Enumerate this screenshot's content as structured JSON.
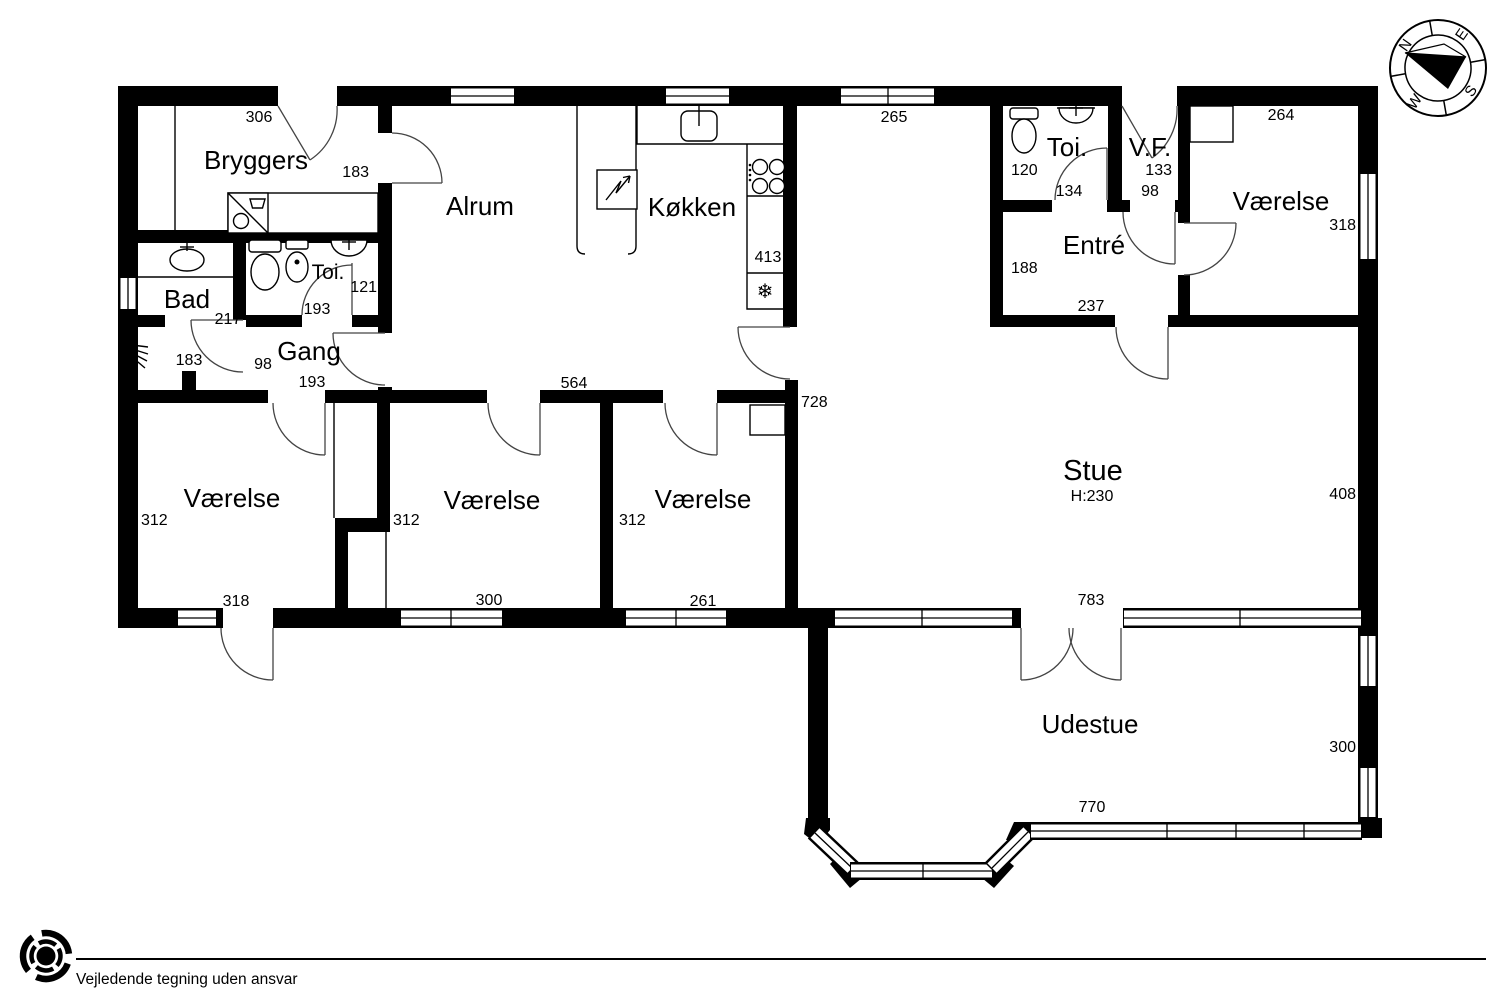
{
  "rooms": {
    "bryggers": {
      "name": "Bryggers",
      "top_width": "306",
      "door_width": "183"
    },
    "bad": {
      "name": "Bad",
      "width": "217",
      "lower_width": "183"
    },
    "toi_west": {
      "name": "Toi.",
      "width": "121",
      "door_width": "193"
    },
    "gang": {
      "name": "Gang",
      "door_width": "98",
      "south_door_width": "193"
    },
    "alrum": {
      "name": "Alrum",
      "south_width": "564"
    },
    "kokken": {
      "name": "Køkken",
      "width": "413"
    },
    "stue": {
      "name": "Stue",
      "ceiling_height": "H:230",
      "west_wall": "728",
      "east_wall": "408",
      "north_window": "265",
      "south_width": "783"
    },
    "toi_east": {
      "name": "Toi.",
      "width": "120",
      "door_width": "134"
    },
    "vf": {
      "name": "V.F.",
      "width": "133",
      "door_width": "98"
    },
    "entre": {
      "name": "Entré",
      "width": "188",
      "south_width": "237"
    },
    "vaerelse_ne": {
      "name": "Værelse",
      "north_width": "264",
      "east_window": "318"
    },
    "vaerelse_sw": {
      "name": "Værelse",
      "west_wall": "312",
      "south_width": "318"
    },
    "vaerelse_s": {
      "name": "Værelse",
      "west_wall": "312",
      "south_width": "300"
    },
    "vaerelse_se": {
      "name": "Værelse",
      "west_wall": "312",
      "south_width": "261"
    },
    "udestue": {
      "name": "Udestue",
      "east_wall": "300",
      "south_width": "770"
    }
  },
  "icons": {
    "fridge_snowflake": "❄"
  },
  "compass": {
    "north": "N",
    "east": "E",
    "south": "S",
    "west": "W"
  },
  "logo": {
    "letter": "e"
  },
  "footer": {
    "disclaimer": "Vejledende tegning uden ansvar"
  }
}
